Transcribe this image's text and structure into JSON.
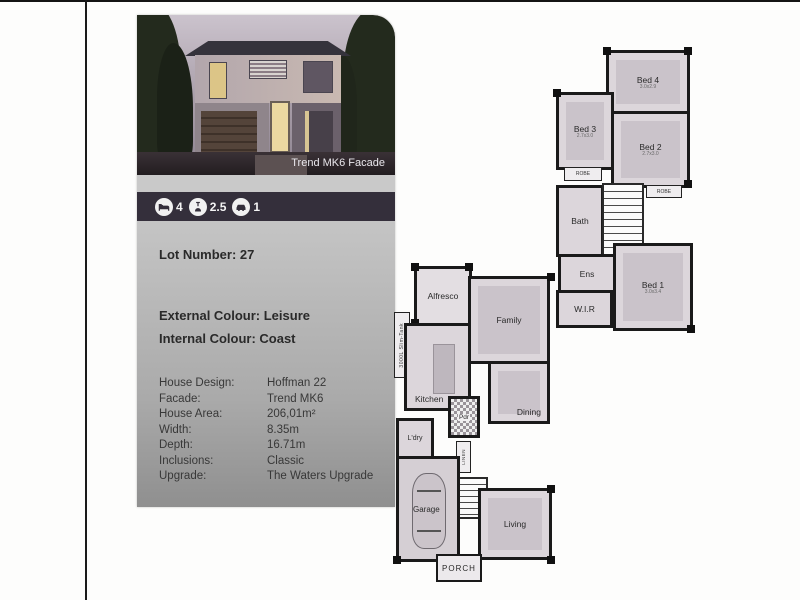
{
  "card": {
    "photo_caption": "Trend MK6 Facade",
    "stats": [
      {
        "icon": "bed-icon",
        "value": "4"
      },
      {
        "icon": "shower-icon",
        "value": "2.5"
      },
      {
        "icon": "car-icon",
        "value": "1"
      }
    ],
    "lot_number": "Lot Number: 27",
    "external_colour": "External Colour: Leisure",
    "internal_colour": "Internal Colour: Coast",
    "details": [
      {
        "label": "House Design:",
        "value": "Hoffman 22"
      },
      {
        "label": "Facade:",
        "value": "Trend MK6"
      },
      {
        "label": "House Area:",
        "value": "206,01m²"
      },
      {
        "label": "Width:",
        "value": "8.35m"
      },
      {
        "label": "Depth:",
        "value": "16.71m"
      },
      {
        "label": "Inclusions:",
        "value": "Classic"
      },
      {
        "label": "Upgrade:",
        "value": "The Waters Upgrade"
      }
    ],
    "colors": {
      "band": "#342f3b",
      "body_top": "#d2d2d2",
      "body_bottom": "#8f8f8f"
    }
  },
  "plans": {
    "upper": {
      "bed4": {
        "label": "Bed 4",
        "dim": "3.0x2.9"
      },
      "bed3": {
        "label": "Bed 3",
        "dim": "2.7x3.0"
      },
      "bed2": {
        "label": "Bed 2",
        "dim": "2.7x3.0"
      },
      "bath": {
        "label": "Bath"
      },
      "ens": {
        "label": "Ens"
      },
      "wir": {
        "label": "W.I.R"
      },
      "bed1": {
        "label": "Bed 1",
        "dim": "3.0x3.4"
      },
      "robe_a": {
        "label": "ROBE"
      },
      "robe_b": {
        "label": "ROBE"
      }
    },
    "ground": {
      "alfresco": {
        "label": "Alfresco"
      },
      "family": {
        "label": "Family"
      },
      "kitchen": {
        "label": "Kitchen"
      },
      "dining": {
        "label": "Dining"
      },
      "ldry": {
        "label": "L'dry"
      },
      "pdr": {
        "label": "Pdr"
      },
      "linen": {
        "label": "LINEN"
      },
      "garage": {
        "label": "Garage"
      },
      "living": {
        "label": "Living"
      },
      "porch": {
        "label": "PORCH"
      },
      "tank": {
        "label": "3000L Slim-Tank"
      }
    }
  }
}
